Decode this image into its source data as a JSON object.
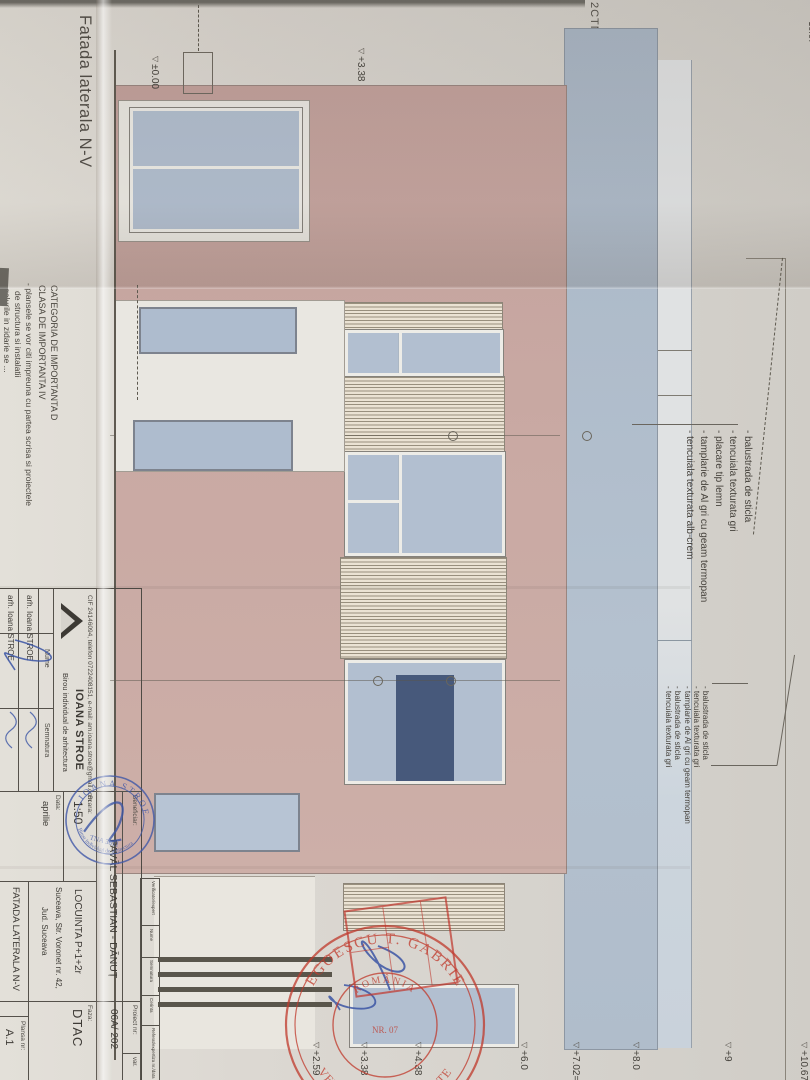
{
  "sheet": {
    "margin_label": "2CTN",
    "corner_level": "+10.67=+"
  },
  "drawing": {
    "title": "Fatada laterala N-V",
    "notes": [
      "CATEGORIA DE IMPORTANTA D",
      "CLASA  DE IMPORTANTA IV",
      "- plansele se vor citi impreuna cu partea scrisa si proiectele",
      "de structura si instalatii",
      "- golurile in zidarie se ..."
    ],
    "annotations_top": [
      "- balustrada de sticla",
      "- tencuiala texturata gri",
      "- placare tip lemn",
      "- tamplarie de Al gri cu geam termopan",
      "- tencuiala texturata alb-crem"
    ],
    "annotations_right": [
      "- balustrada de sticla",
      "- tencuiala texturata gri",
      "- tamplarie de Al gri cu geam termopan",
      "- balustrada de sticla",
      "- tencuiala texturata gri"
    ],
    "levels_left": [
      {
        "text": "±0.00"
      },
      {
        "text": "+3.38"
      }
    ],
    "levels_right": [
      {
        "text": "+2.59"
      },
      {
        "text": "+3.38"
      },
      {
        "text": "+4.38"
      },
      {
        "text": "+6.0"
      },
      {
        "text": "+7.02=7"
      },
      {
        "text": "+8.0"
      },
      {
        "text": "+9"
      },
      {
        "text": "+10.67=1"
      }
    ],
    "icons": {
      "level_marker": "▽"
    }
  },
  "titleblock": {
    "contact": "CIF 24146094, telefon 0722408151, e-mail: am.ioana.stroe@gmail.com",
    "firm": "IOANA STROE",
    "firm_sub": "Birou individual de arhitectura",
    "col_nume": "Nume",
    "col_semnatura": "Semnatura",
    "name_row1": "arh. Ioana STROE",
    "name_row2": "arh. Ioana STROE",
    "beneficiar_label": "Beneficiar:",
    "beneficiar": "PAVĂL SEBASTIAN - DĂNUȚ",
    "proiect_label": "Proiect nr:",
    "proiect_nr": "06A/ 202",
    "var_label": "var.",
    "scara_label": "Scara:",
    "scara": "1:50",
    "data_label": "Data:",
    "data": "aprilie",
    "titlu_proiect": "LOCUINTA P+1+2r",
    "adresa1": "Suceava, Str. Voronet nr. 42,",
    "adresa2": "Jud. Suceava",
    "faza_label": "Faza:",
    "faza": "DTAC",
    "titlu_plansa": "FATADA LATERALA N-V",
    "plansa_label": "Plansa nr:",
    "plansa_nr": "A.1",
    "verif_strip": {
      "c1": "Verificator/expert",
      "c2": "Nume",
      "c3": "Semnatura",
      "c4": "Cerinta",
      "c5": "Referat/expertiza nr./data"
    }
  },
  "stamps": {
    "blue": {
      "top": "IOANA STROE",
      "bottom": "Birou individual de arhitectura",
      "center": "TNA 3631"
    },
    "red": {
      "top": "NEGOESCU T. GABRIEL",
      "bottom": "★ VERIFICATOR PROIECTE ★",
      "inner_top": "ROMÂNIA",
      "inner_center": "NR. 07"
    }
  }
}
